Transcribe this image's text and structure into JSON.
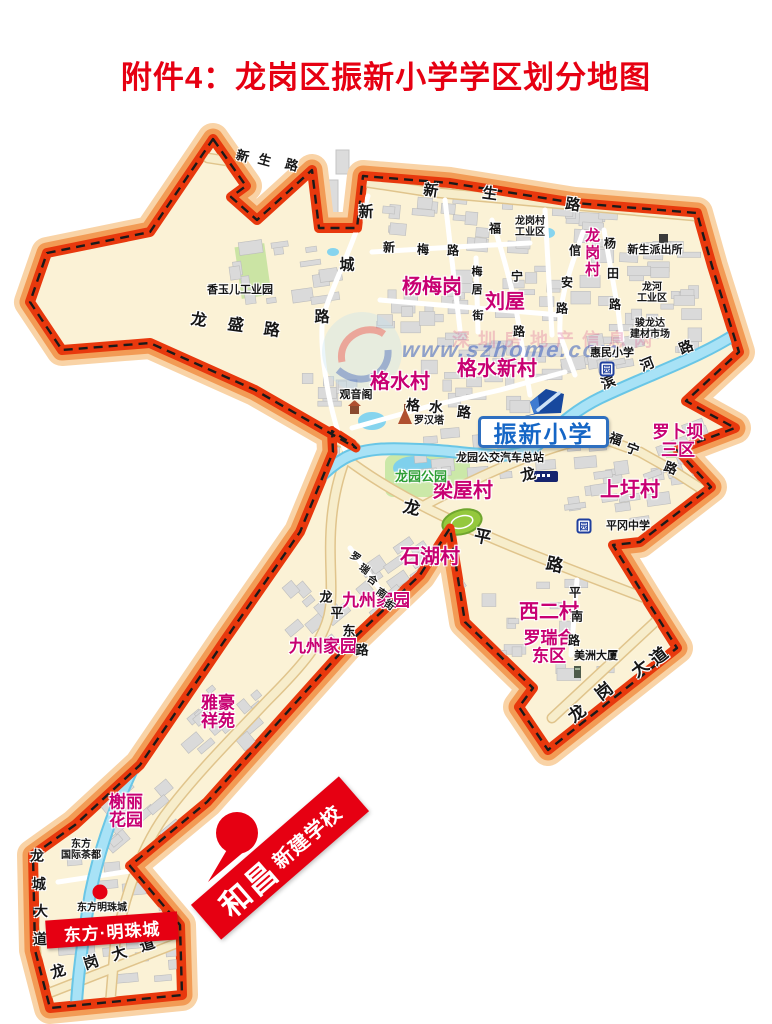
{
  "title": "附件4：龙岗区振新小学学区划分地图",
  "colors": {
    "title_red": "#E60012",
    "boundary_red": "#E8380D",
    "boundary_orange": "#F29B55",
    "boundary_light": "#F9D3A6",
    "district_cream": "#FBF2D6",
    "village_magenta": "#C80072",
    "school_blue": "#1566C6",
    "marker_red": "#E60012",
    "river_blue": "#8FD8EE",
    "park_green": "#2E9E35"
  },
  "map": {
    "school": {
      "label": "振新小学"
    },
    "marker": {
      "line1": "和昌",
      "line2": "新建学校"
    },
    "estate": {
      "label": "东方·明珠城"
    },
    "watermark": {
      "cn": "深圳房地产信息网",
      "url": "www.szhome.com"
    },
    "metro_glyph": "园",
    "metro_icons": [
      {
        "x": 607,
        "y": 369
      },
      {
        "x": 584,
        "y": 526
      },
      {
        "x": 592,
        "y": 431
      }
    ],
    "labels": [
      {
        "t": "杨梅岗",
        "x": 432,
        "y": 288,
        "c": "village"
      },
      {
        "t": "刘屋",
        "x": 505,
        "y": 303,
        "c": "village"
      },
      {
        "t": "龙岗村",
        "x": 591,
        "y": 253,
        "c": "village",
        "vert": true,
        "fs": 15
      },
      {
        "t": "格水村",
        "x": 400,
        "y": 383,
        "c": "village"
      },
      {
        "t": "格水新村",
        "x": 497,
        "y": 370,
        "c": "village"
      },
      {
        "lines": [
          "罗卜坝",
          "三区"
        ],
        "x": 678,
        "y": 442,
        "c": "village sm"
      },
      {
        "t": "上圩村",
        "x": 630,
        "y": 491,
        "c": "village"
      },
      {
        "t": "梁屋村",
        "x": 463,
        "y": 492,
        "c": "village"
      },
      {
        "t": "石湖村",
        "x": 430,
        "y": 558,
        "c": "village"
      },
      {
        "t": "九州家园",
        "x": 376,
        "y": 601,
        "c": "village sm"
      },
      {
        "t": "九州家园",
        "x": 323,
        "y": 647,
        "c": "village sm"
      },
      {
        "t": "西二村",
        "x": 549,
        "y": 613,
        "c": "village"
      },
      {
        "lines": [
          "罗瑞合",
          "东区"
        ],
        "x": 549,
        "y": 648,
        "c": "village sm"
      },
      {
        "lines": [
          "雅豪",
          "祥苑"
        ],
        "x": 218,
        "y": 713,
        "c": "village sm"
      },
      {
        "lines": [
          "榭丽",
          "花园"
        ],
        "x": 126,
        "y": 812,
        "c": "village sm"
      },
      {
        "t": "香玉儿工业园",
        "x": 240,
        "y": 291,
        "c": "poi"
      },
      {
        "lines": [
          "龙岗村",
          "工业区"
        ],
        "x": 530,
        "y": 228,
        "c": "poi xs"
      },
      {
        "t": "新生派出所",
        "x": 655,
        "y": 251,
        "c": "poi"
      },
      {
        "lines": [
          "龙河",
          "工业区"
        ],
        "x": 652,
        "y": 294,
        "c": "poi xs"
      },
      {
        "lines": [
          "骏龙达",
          "建材市场"
        ],
        "x": 650,
        "y": 330,
        "c": "poi xs"
      },
      {
        "t": "惠民小学",
        "x": 612,
        "y": 354,
        "c": "poi"
      },
      {
        "t": "观音阁",
        "x": 356,
        "y": 396,
        "c": "poi"
      },
      {
        "t": "罗汉塔",
        "x": 429,
        "y": 422,
        "c": "poi xs"
      },
      {
        "t": "龙园公交汽车总站",
        "x": 500,
        "y": 459,
        "c": "poi"
      },
      {
        "t": "平冈中学",
        "x": 628,
        "y": 527,
        "c": "poi"
      },
      {
        "t": "美洲大厦",
        "x": 596,
        "y": 657,
        "c": "poi"
      },
      {
        "lines": [
          "东方",
          "国际茶都"
        ],
        "x": 81,
        "y": 851,
        "c": "poi xs"
      },
      {
        "t": "东方明珠城",
        "x": 102,
        "y": 909,
        "c": "poi xs"
      },
      {
        "t": "龙园公园",
        "x": 421,
        "y": 477,
        "c": "park"
      }
    ],
    "roads": [
      {
        "name": "新生路",
        "s": 13,
        "rot": 15,
        "chars": [
          [
            "新",
            243,
            155
          ],
          [
            "生",
            265,
            159
          ],
          [
            "路",
            292,
            164
          ]
        ]
      },
      {
        "name": "新生路",
        "s": 15,
        "rot": 8,
        "chars": [
          [
            "新",
            431,
            190
          ],
          [
            "生",
            490,
            193
          ],
          [
            "路",
            573,
            204
          ]
        ]
      },
      {
        "name": "新城路",
        "s": 15,
        "rot": 0,
        "chars": [
          [
            "新",
            366,
            211
          ],
          [
            "城",
            347,
            264
          ],
          [
            "路",
            322,
            316
          ]
        ]
      },
      {
        "name": "龙盛路",
        "s": 16,
        "rot": 8,
        "chars": [
          [
            "龙",
            199,
            318
          ],
          [
            "盛",
            236,
            323
          ],
          [
            "路",
            272,
            328
          ]
        ]
      },
      {
        "name": "新梅路",
        "s": 12,
        "rot": 0,
        "chars": [
          [
            "新",
            389,
            247
          ],
          [
            "梅",
            423,
            249
          ],
          [
            "路",
            453,
            250
          ]
        ]
      },
      {
        "name": "梅居街",
        "s": 11,
        "rot": 0,
        "chars": [
          [
            "梅",
            477,
            271
          ],
          [
            "居",
            477,
            289
          ],
          [
            "街",
            478,
            315
          ]
        ]
      },
      {
        "name": "福宁路",
        "s": 12,
        "rot": 0,
        "chars": [
          [
            "福",
            495,
            228
          ],
          [
            "宁",
            517,
            276
          ],
          [
            "路",
            519,
            331
          ]
        ]
      },
      {
        "name": "倌安路",
        "s": 12,
        "rot": 0,
        "chars": [
          [
            "倌",
            575,
            250
          ],
          [
            "安",
            567,
            282
          ],
          [
            "路",
            562,
            308
          ]
        ]
      },
      {
        "name": "杨田路",
        "s": 12,
        "rot": 0,
        "chars": [
          [
            "杨",
            610,
            243
          ],
          [
            "田",
            613,
            273
          ],
          [
            "路",
            615,
            304
          ]
        ]
      },
      {
        "name": "格水路",
        "s": 14,
        "rot": 5,
        "chars": [
          [
            "格",
            413,
            405
          ],
          [
            "水",
            436,
            407
          ],
          [
            "路",
            464,
            412
          ]
        ]
      },
      {
        "name": "滨河路",
        "s": 14,
        "rot": -22,
        "chars": [
          [
            "滨",
            608,
            382
          ],
          [
            "河",
            647,
            364
          ],
          [
            "路",
            686,
            347
          ]
        ]
      },
      {
        "name": "福宁路",
        "s": 13,
        "rot": 20,
        "chars": [
          [
            "福",
            616,
            438
          ],
          [
            "宁",
            633,
            448
          ],
          [
            "路",
            671,
            467
          ]
        ]
      },
      {
        "name": "龙平路",
        "s": 17,
        "rot": 12,
        "chars": [
          [
            "龙",
            412,
            506
          ],
          [
            "平",
            483,
            535
          ],
          [
            "路",
            555,
            563
          ]
        ]
      },
      {
        "name": "龙园路",
        "s": 15,
        "rot": -15,
        "chars": [
          [
            "龙",
            528,
            474
          ]
        ]
      },
      {
        "name": "龙平东路",
        "s": 13,
        "rot": 0,
        "chars": [
          [
            "龙",
            326,
            596
          ],
          [
            "平",
            337,
            612
          ],
          [
            "东",
            349,
            630
          ],
          [
            "路",
            362,
            649
          ]
        ]
      },
      {
        "name": "罗瑞合南街",
        "s": 10,
        "rot": 35,
        "chars": [
          [
            "罗",
            356,
            556
          ],
          [
            "瑞",
            365,
            568
          ],
          [
            "合",
            373,
            579
          ],
          [
            "南",
            382,
            592
          ],
          [
            "街",
            390,
            604
          ]
        ]
      },
      {
        "name": "平南路",
        "s": 12,
        "rot": 0,
        "chars": [
          [
            "平",
            575,
            592
          ],
          [
            "南",
            577,
            616
          ],
          [
            "路",
            574,
            640
          ]
        ]
      },
      {
        "name": "龙岗大道",
        "s": 17,
        "rot": -38,
        "chars": [
          [
            "龙",
            576,
            712
          ],
          [
            "岗",
            603,
            690
          ],
          [
            "大",
            639,
            667
          ],
          [
            "道",
            658,
            655
          ]
        ]
      },
      {
        "name": "龙城大道",
        "s": 14,
        "rot": 0,
        "chars": [
          [
            "龙",
            37,
            856
          ],
          [
            "城",
            39,
            884
          ],
          [
            "大",
            41,
            911
          ],
          [
            "道",
            40,
            939
          ]
        ]
      },
      {
        "name": "龙岗大道",
        "s": 15,
        "rot": -18,
        "chars": [
          [
            "龙",
            58,
            971
          ],
          [
            "岗",
            91,
            962
          ],
          [
            "大",
            119,
            953
          ],
          [
            "道",
            147,
            944
          ]
        ]
      }
    ]
  }
}
